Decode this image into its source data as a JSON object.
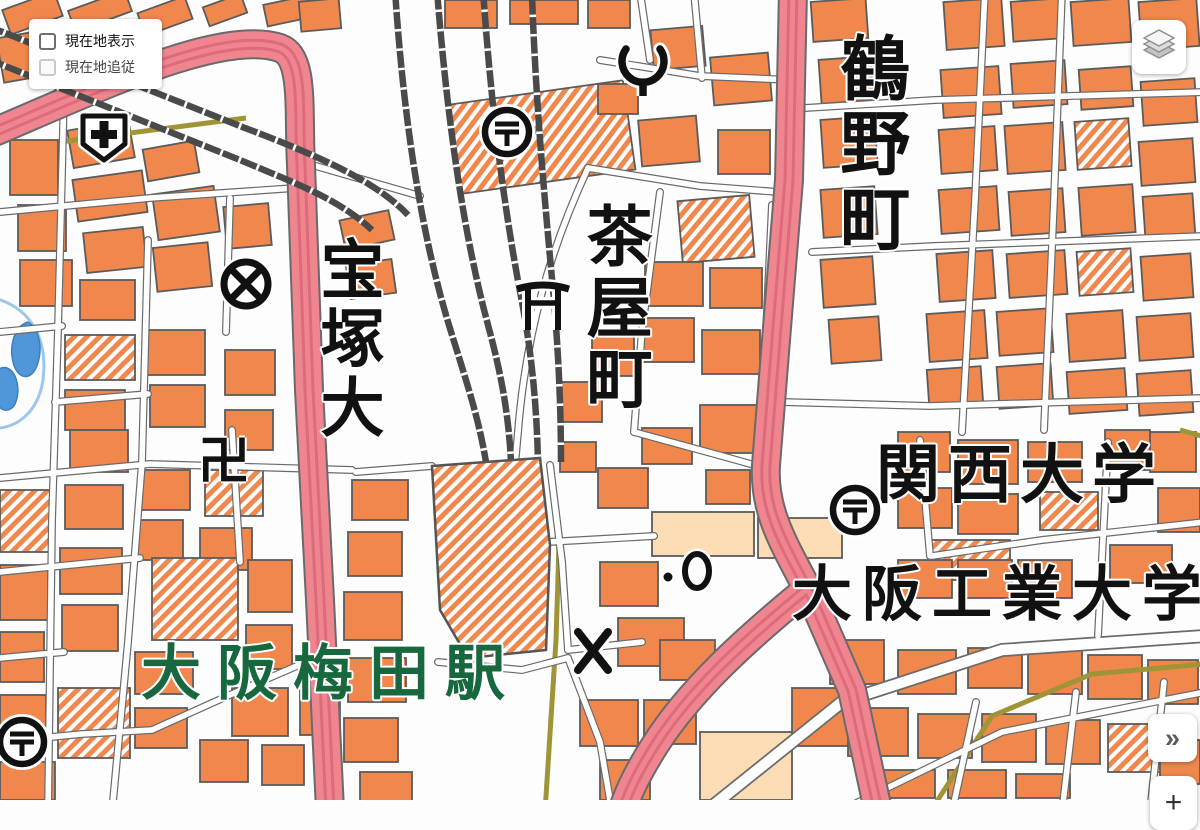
{
  "controls": {
    "location_panel": {
      "options": [
        {
          "label": "現在地表示",
          "checked": false,
          "disabled": false
        },
        {
          "label": "現在地追従",
          "checked": false,
          "disabled": true
        }
      ]
    },
    "layers_button": {
      "name": "layers"
    },
    "collapse_button": {
      "glyph": "»"
    },
    "zoom_in_button": {
      "glyph": "+"
    }
  },
  "map": {
    "place_labels": [
      {
        "id": "takarazuka",
        "text": "宝塚大",
        "orientation": "vertical",
        "color": "#111111"
      },
      {
        "id": "chayamachi",
        "text": "茶屋町",
        "orientation": "vertical",
        "color": "#111111"
      },
      {
        "id": "tsurunocho",
        "text": "鶴野町",
        "orientation": "vertical",
        "color": "#111111"
      },
      {
        "id": "kansai-university",
        "text": "関西大学",
        "orientation": "horizontal",
        "color": "#111111"
      },
      {
        "id": "osaka-institute-of-technology",
        "text": "大阪工業大学",
        "orientation": "horizontal",
        "color": "#111111"
      },
      {
        "id": "osaka-umeda-station",
        "text": "大阪梅田駅",
        "orientation": "horizontal",
        "color": "#17683f"
      }
    ],
    "symbols": [
      {
        "name": "hospital-symbol"
      },
      {
        "name": "police-station-symbol"
      },
      {
        "name": "post-office-symbol-north"
      },
      {
        "name": "post-office-symbol-east"
      },
      {
        "name": "post-office-symbol-southwest"
      },
      {
        "name": "fire-station-symbol"
      },
      {
        "name": "shrine-symbol"
      },
      {
        "name": "temple-symbol",
        "glyph": "卍"
      },
      {
        "name": "koban-symbol"
      },
      {
        "name": "ward-office-symbol"
      },
      {
        "name": "spot-dot-symbol"
      }
    ],
    "colors": {
      "building": "#f0874d",
      "building_light": "#fbdcb4",
      "building_outline": "#5b5b5b",
      "major_road": "#ef858e",
      "major_road_stripe": "#dd6b7c",
      "road_casing": "#6a6a6a",
      "railway": "#4a4a4a",
      "olive_road": "#a09536",
      "water": "#4f97d8",
      "water_line": "#9cc6ec",
      "station_text": "#17683f"
    }
  }
}
